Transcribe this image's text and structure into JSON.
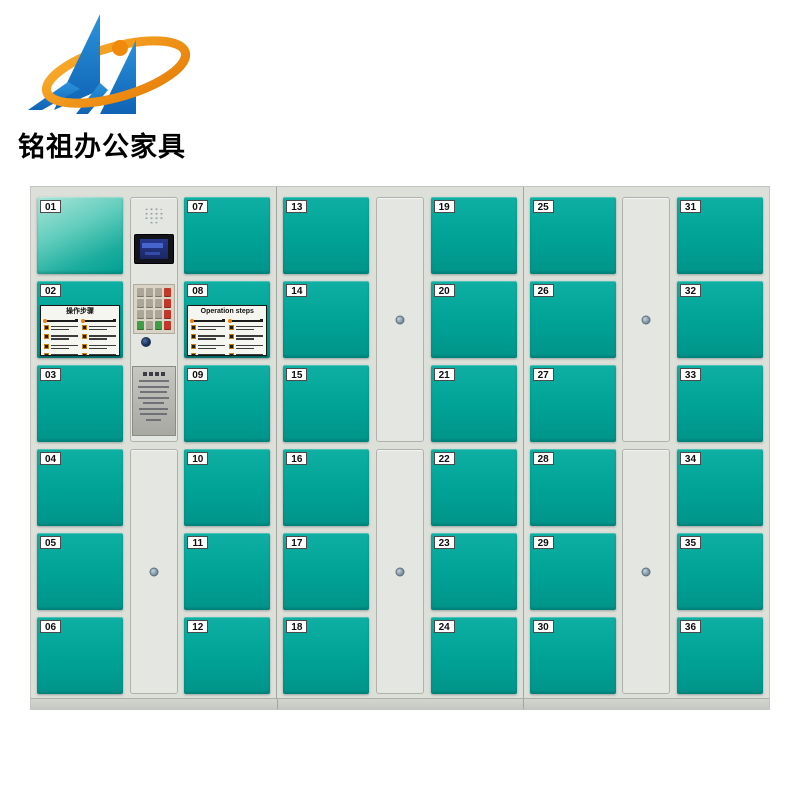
{
  "brand": {
    "name": "铭祖办公家具",
    "logo_colors": {
      "blue": "#1878C8",
      "orange": "#F08A0C"
    }
  },
  "locker": {
    "door_color": "#00A79B",
    "frame_color": "#DDDFD9",
    "mirror_door": "01",
    "cabinets": [
      {
        "left_doors": [
          "01",
          "02",
          "03",
          "04",
          "05",
          "06"
        ],
        "middle": "control-panel",
        "right_doors": [
          "07",
          "08",
          "09",
          "10",
          "11",
          "12"
        ]
      },
      {
        "left_doors": [
          "13",
          "14",
          "15",
          "16",
          "17",
          "18"
        ],
        "middle": "blank-doors",
        "right_doors": [
          "19",
          "20",
          "21",
          "22",
          "23",
          "24"
        ]
      },
      {
        "left_doors": [
          "25",
          "26",
          "27",
          "28",
          "29",
          "30"
        ],
        "middle": "blank-doors",
        "right_doors": [
          "31",
          "32",
          "33",
          "34",
          "35",
          "36"
        ]
      }
    ],
    "steps_panels": [
      {
        "door": "02",
        "title": "操作步骤",
        "columns": 2,
        "items_per_column": 4
      },
      {
        "door": "08",
        "title": "Operation steps",
        "columns": 2,
        "items_per_column": 4
      }
    ]
  }
}
